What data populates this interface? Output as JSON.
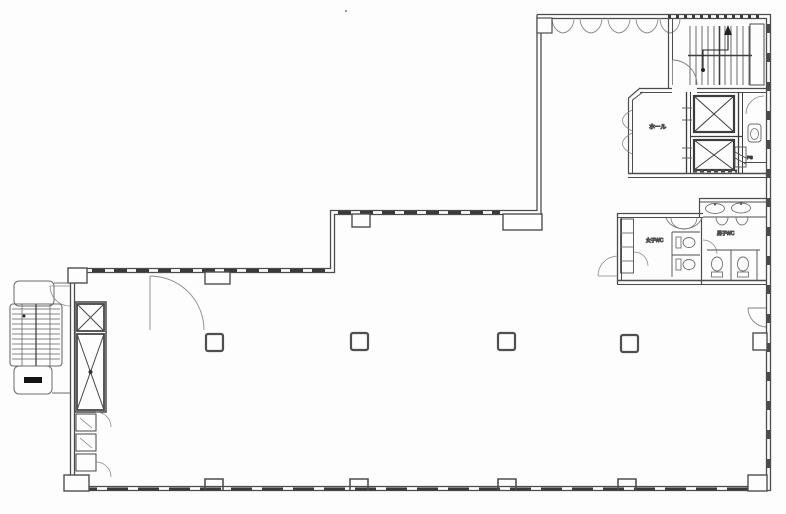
{
  "figure": {
    "kind": "architectural-floor-plan",
    "canvas": {
      "width": 786,
      "height": 514
    }
  },
  "labels": {
    "hall": "ホール",
    "womens_wc": "女子WC",
    "mens_wc": "男子WC",
    "duct": "PS"
  },
  "colors": {
    "paper": "#fdfdfd",
    "wall": "#4d4d4d",
    "wall_dark": "#3a3a3a",
    "fixture": "#707070",
    "light": "#8a8a8a",
    "ink_fill": "#141414"
  }
}
